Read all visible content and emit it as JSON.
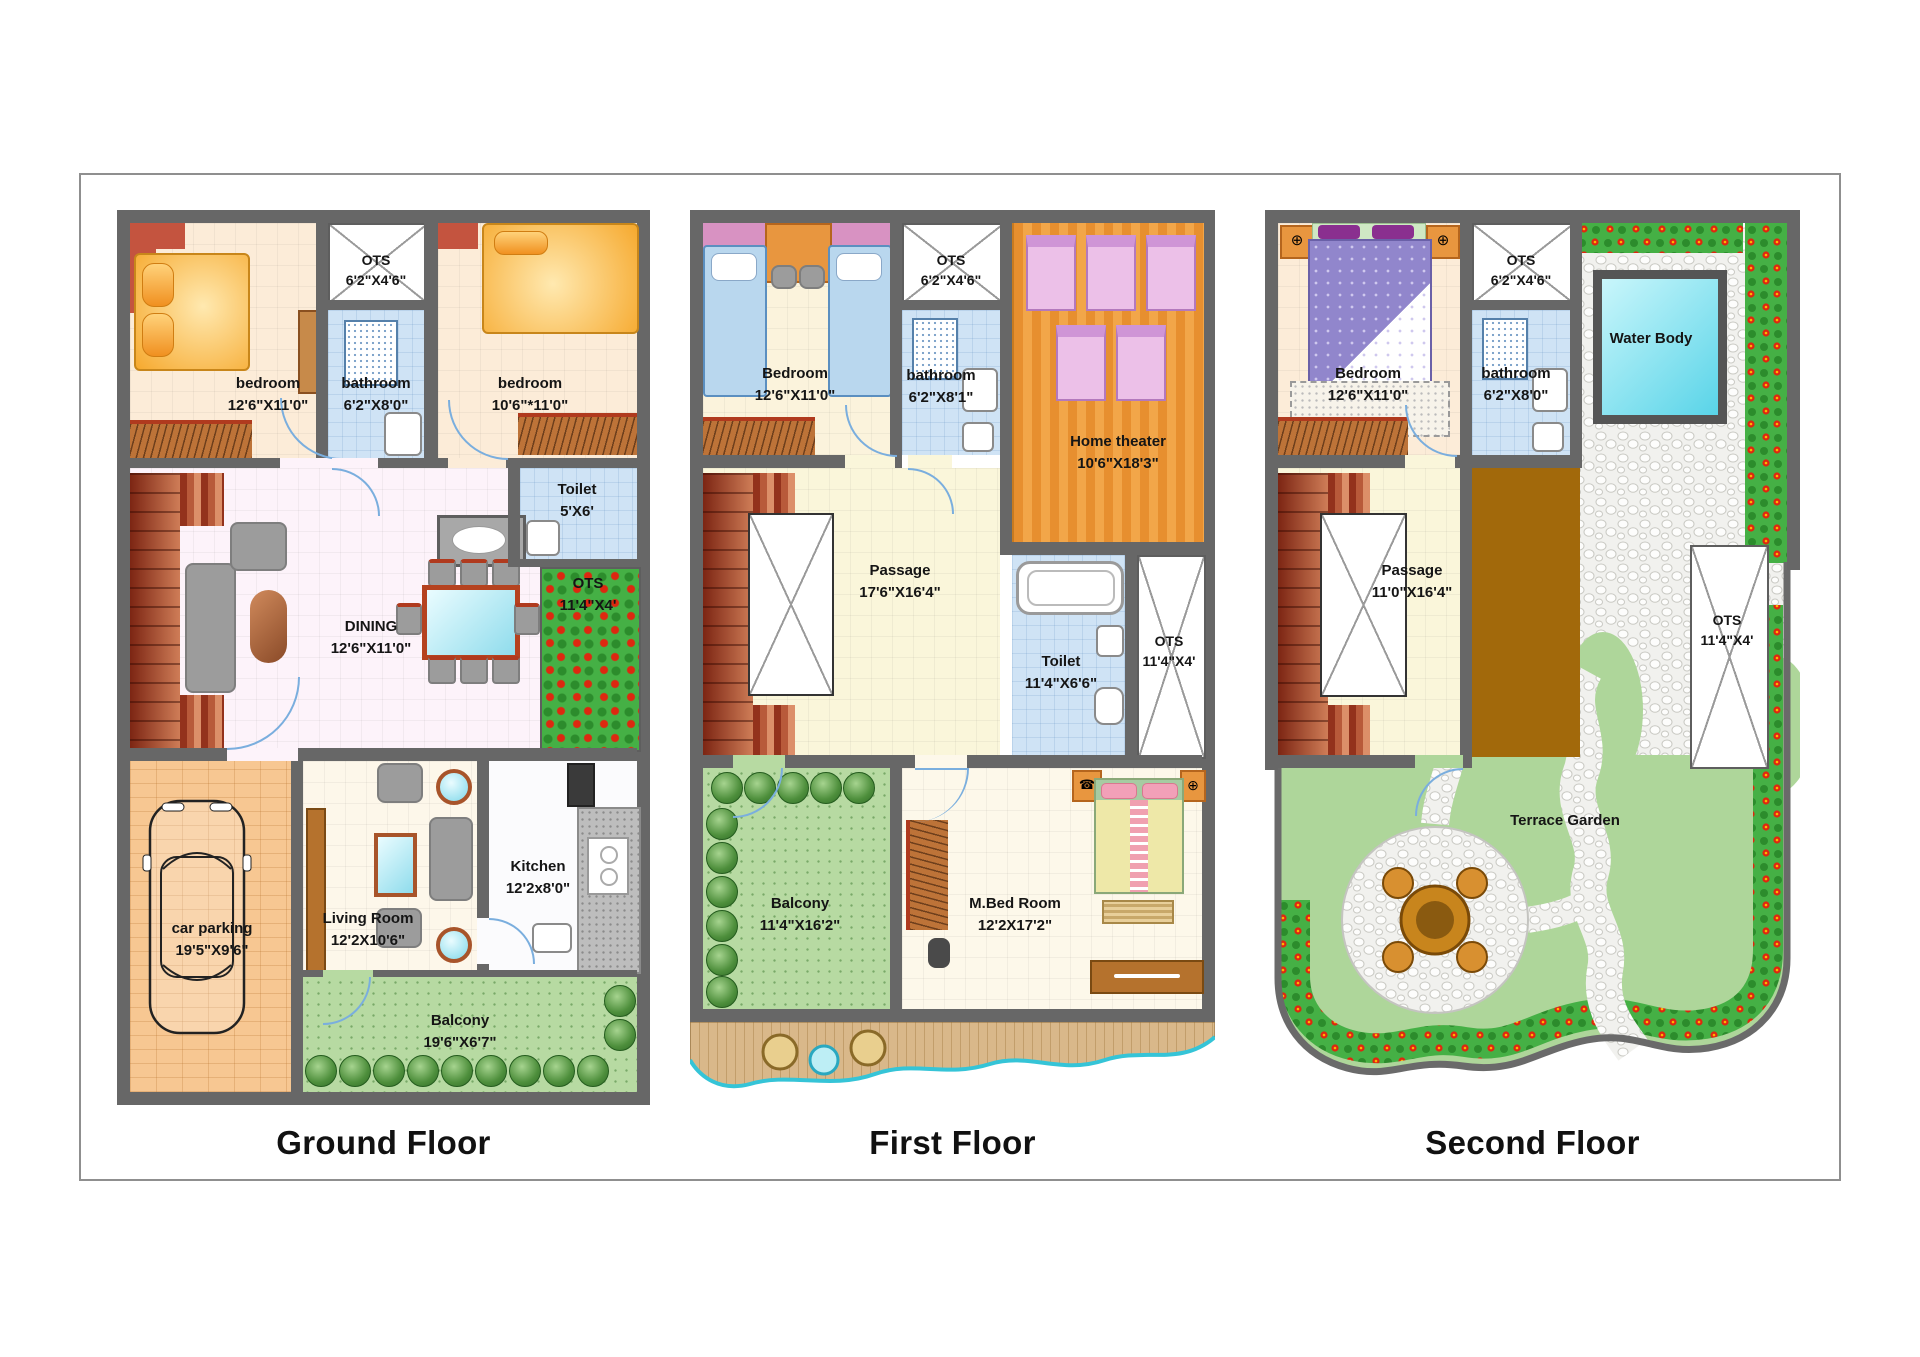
{
  "titles": {
    "ground": "Ground Floor",
    "first": "First Floor",
    "second": "Second Floor"
  },
  "ground": {
    "bedroom1": {
      "name": "bedroom",
      "dims": "12'6\"X11'0\""
    },
    "ots_top": {
      "name": "OTS",
      "dims": "6'2\"X4'6\""
    },
    "bathroom": {
      "name": "bathroom",
      "dims": "6'2\"X8'0\""
    },
    "bedroom2": {
      "name": "bedroom",
      "dims": "10'6\"*11'0\""
    },
    "toilet": {
      "name": "Toilet",
      "dims": "5'X6'"
    },
    "ots_side": {
      "name": "OTS",
      "dims": "11'4\"X4'"
    },
    "dining": {
      "name": "DINING",
      "dims": "12'6\"X11'0\""
    },
    "car_parking": {
      "name": "car parking",
      "dims": "19'5\"X9'6\""
    },
    "living_room": {
      "name": "Living Room",
      "dims": "12'2X10'6\""
    },
    "kitchen": {
      "name": "Kitchen",
      "dims": "12'2x8'0\""
    },
    "balcony": {
      "name": "Balcony",
      "dims": "19'6\"X6'7\""
    }
  },
  "first": {
    "bedroom": {
      "name": "Bedroom",
      "dims": "12'6\"X11'0\""
    },
    "ots_top": {
      "name": "OTS",
      "dims": "6'2\"X4'6\""
    },
    "bathroom": {
      "name": "bathroom",
      "dims": "6'2\"X8'1\""
    },
    "home_theater": {
      "name": "Home theater",
      "dims": "10'6\"X18'3\""
    },
    "passage": {
      "name": "Passage",
      "dims": "17'6\"X16'4\""
    },
    "toilet": {
      "name": "Toilet",
      "dims": "11'4\"X6'6\""
    },
    "ots_side": {
      "name": "OTS",
      "dims": "11'4\"X4'"
    },
    "balcony": {
      "name": "Balcony",
      "dims": "11'4\"X16'2\""
    },
    "m_bed_room": {
      "name": "M.Bed Room",
      "dims": "12'2X17'2\""
    }
  },
  "second": {
    "bedroom": {
      "name": "Bedroom",
      "dims": "12'6\"X11'0\""
    },
    "ots_top": {
      "name": "OTS",
      "dims": "6'2\"X4'6\""
    },
    "bathroom": {
      "name": "bathroom",
      "dims": "6'2\"X8'0\""
    },
    "water_body": {
      "name": "Water Body"
    },
    "passage": {
      "name": "Passage",
      "dims": "11'0\"X16'4\""
    },
    "ots_side": {
      "name": "OTS",
      "dims": "11'4\"X4'"
    },
    "terrace_garden": {
      "name": "Terrace Garden"
    }
  },
  "colors": {
    "wall": "#676767",
    "door_arc": "#7aaede",
    "water": "#59d4e8",
    "lawn": "#aed69a",
    "flower_red": "#dd2810",
    "stairs": "#7c2513"
  }
}
